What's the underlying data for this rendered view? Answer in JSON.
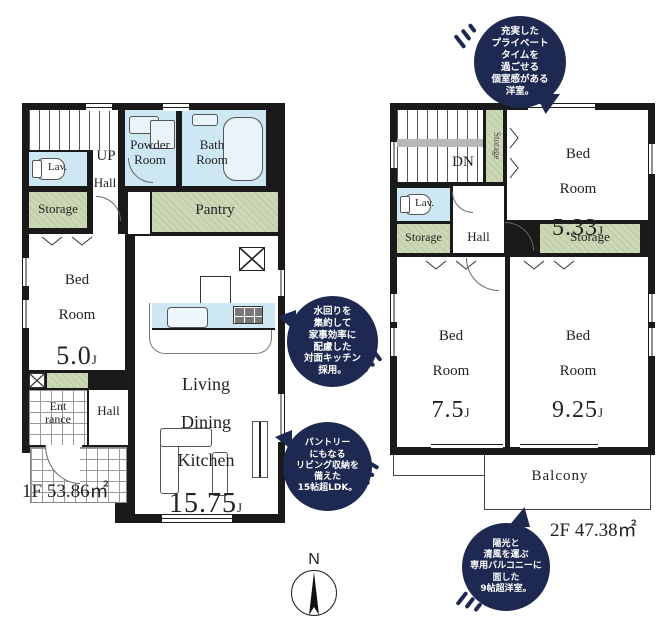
{
  "colors": {
    "wall": "#1a1a1a",
    "water_blue": "#cde7f3",
    "storage_green": "#ccd8b5",
    "bubble_navy": "#1d2950",
    "bubble_text": "#ffffff"
  },
  "compass": {
    "north": "N"
  },
  "bubbles": {
    "private": "充実した\nプライベート\nタイムを\n過ごせる\n個室感がある\n洋室。",
    "kitchen": "水回りを\n集約して\n家事効率に\n配慮した\n対面キッチン\n採用。",
    "ldk": "パントリー\nにもなる\nリビング収納を\n備えた\n15帖超LDK。",
    "balcony": "陽光と\n清風を運ぶ\n専用バルコニーに\n面した\n9帖超洋室。"
  },
  "floor1": {
    "area": "1F 53.86㎡",
    "up": "UP",
    "hall_upper": "Hall",
    "lav": "Lav.",
    "storage": "Storage",
    "powder": "Powder\nRoom",
    "bath": "Bath\nRoom",
    "pantry": "Pantry",
    "bedroom": {
      "l1": "Bed",
      "l2": "Room",
      "value": "5.0",
      "unit": "J"
    },
    "entrance": "Ent\nrance",
    "hall_lower": "Hall",
    "ldk": {
      "l1": "Living",
      "l2": "Dining",
      "l3": "Kitchen",
      "value": "15.75",
      "unit": "J"
    }
  },
  "floor2": {
    "area": "2F 47.38㎡",
    "dn": "DN",
    "storage_stair": "Storage",
    "lav": "Lav.",
    "storage_left": "Storage",
    "hall": "Hall",
    "storage_right": "Storage",
    "bedroom_533": {
      "l1": "Bed",
      "l2": "Room",
      "value": "5.33",
      "unit": "J"
    },
    "bedroom_75": {
      "l1": "Bed",
      "l2": "Room",
      "value": "7.5",
      "unit": "J"
    },
    "bedroom_925": {
      "l1": "Bed",
      "l2": "Room",
      "value": "9.25",
      "unit": "J"
    },
    "balcony": "Balcony"
  }
}
